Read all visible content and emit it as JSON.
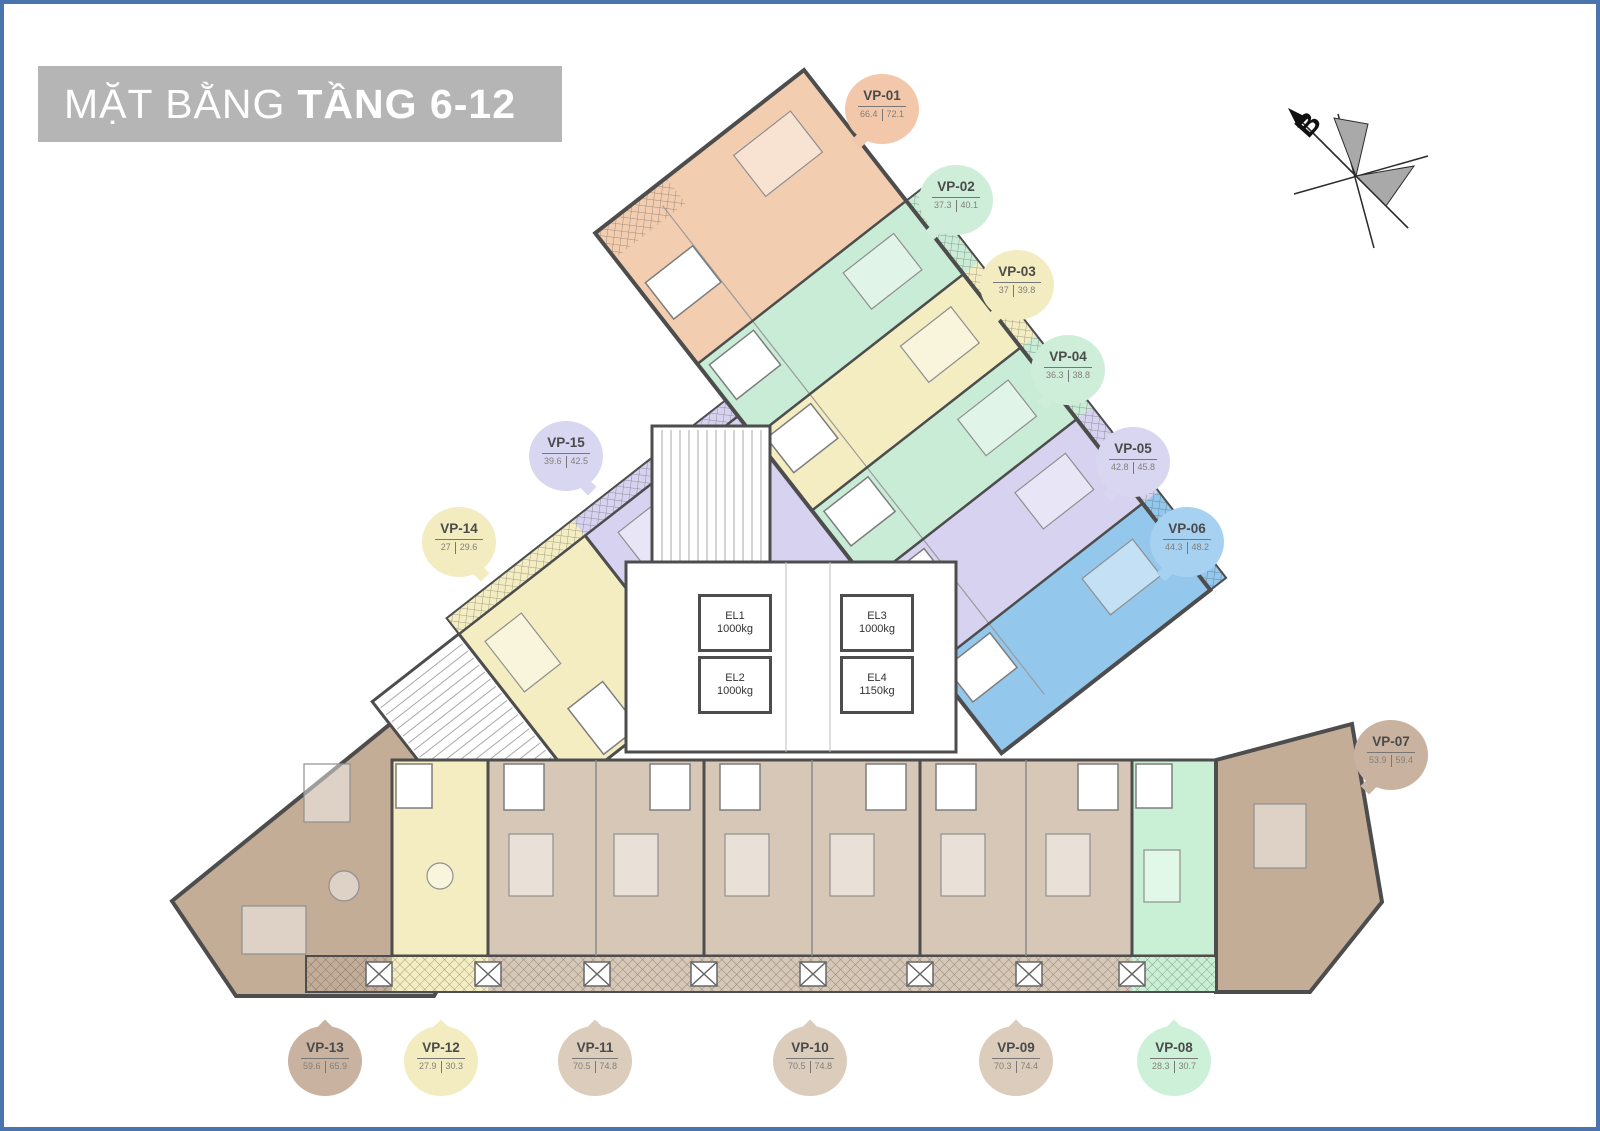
{
  "title": {
    "normal": "MẶT BẰNG",
    "bold": "TẦNG 6-12"
  },
  "compass": {
    "label": "B"
  },
  "units": {
    "vp01": {
      "id": "VP-01",
      "area_net": "66.4",
      "area_gross": "72.1",
      "color": "#f3cdb0"
    },
    "vp02": {
      "id": "VP-02",
      "area_net": "37.3",
      "area_gross": "40.1",
      "color": "#c9ecd6"
    },
    "vp03": {
      "id": "VP-03",
      "area_net": "37",
      "area_gross": "39.8",
      "color": "#f4edc2"
    },
    "vp04": {
      "id": "VP-04",
      "area_net": "36.3",
      "area_gross": "38.8",
      "color": "#c9ecd6"
    },
    "vp05": {
      "id": "VP-05",
      "area_net": "42.8",
      "area_gross": "45.8",
      "color": "#d6d2ef"
    },
    "vp06": {
      "id": "VP-06",
      "area_net": "44.3",
      "area_gross": "48.2",
      "color": "#93c7ec"
    },
    "vp07": {
      "id": "VP-07",
      "area_net": "53.9",
      "area_gross": "59.4",
      "color": "#c4ad97"
    },
    "vp08": {
      "id": "VP-08",
      "area_net": "28.3",
      "area_gross": "30.7",
      "color": "#c9f0d4"
    },
    "vp09": {
      "id": "VP-09",
      "area_net": "70.3",
      "area_gross": "74.4",
      "color": "#d7c7b6"
    },
    "vp10": {
      "id": "VP-10",
      "area_net": "70.5",
      "area_gross": "74.8",
      "color": "#d7c7b6"
    },
    "vp11": {
      "id": "VP-11",
      "area_net": "70.5",
      "area_gross": "74.8",
      "color": "#d7c7b6"
    },
    "vp12": {
      "id": "VP-12",
      "area_net": "27.9",
      "area_gross": "30.3",
      "color": "#f4edc2"
    },
    "vp13": {
      "id": "VP-13",
      "area_net": "59.6",
      "area_gross": "65.9",
      "color": "#c4ad97"
    },
    "vp14": {
      "id": "VP-14",
      "area_net": "27",
      "area_gross": "29.6",
      "color": "#f4edc2"
    },
    "vp15": {
      "id": "VP-15",
      "area_net": "39.6",
      "area_gross": "42.5",
      "color": "#d6d2ef"
    }
  },
  "elevators": {
    "el1": {
      "id": "EL1",
      "capacity": "1000kg"
    },
    "el2": {
      "id": "EL2",
      "capacity": "1000kg"
    },
    "el3": {
      "id": "EL3",
      "capacity": "1000kg"
    },
    "el4": {
      "id": "EL4",
      "capacity": "1150kg"
    }
  },
  "palette": {
    "page_border": "#4a74ae",
    "banner_gray": "#b5b5b5",
    "wall_gray": "#4d4d4d"
  }
}
